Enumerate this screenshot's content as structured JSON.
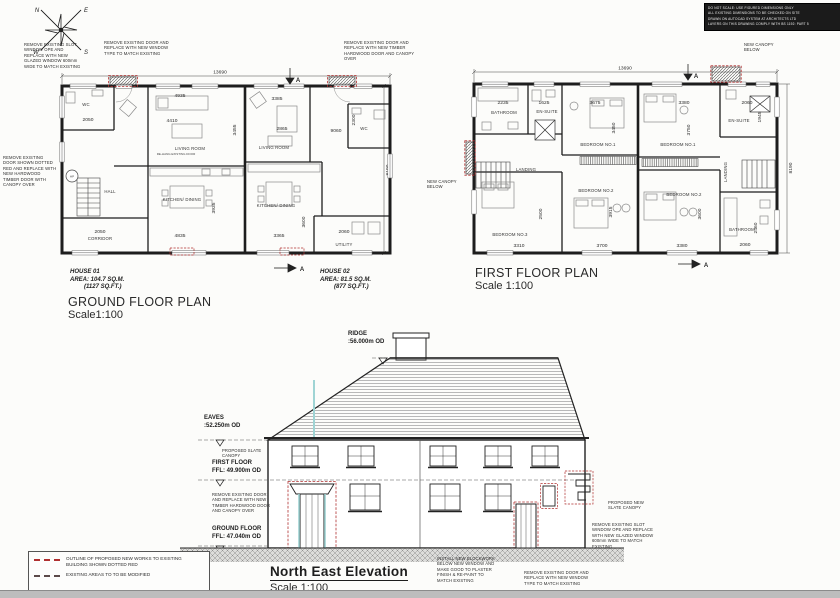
{
  "colors": {
    "ink": "#1d1d1d",
    "proposed_red": "#b03030",
    "teal": "#9fd4d4"
  },
  "compass": {
    "n": "N",
    "e": "E",
    "w": "W",
    "s": "S"
  },
  "notes_block": {
    "l1": "DO NOT SCALE: USE FIGURED DIMENSIONS ONLY",
    "l2": "ALL EXISTING DIMENSIONS TO BE CHECKED ON SITE",
    "l3": "DRAWN ON AUTOCAD SYSTEM AT ARCHITECTS LTD",
    "l4": "LAYERS ON THIS DRAWING COMPLY WITH BS 1192: PART 5"
  },
  "annotations": {
    "slot_window": "REMOVE EXISTING SLOT WINDOW OPE AND REPLACE WITH NEW GLAZED WINDOW 600mm WIDE TO MATCH EXISTING",
    "door_to_window": "REMOVE EXISTING DOOR AND REPLACE WITH NEW WINDOW TYPE TO MATCH EXISTING",
    "door_timber": "REMOVE EXISTING DOOR AND REPLACE WITH NEW TIMBER HARDWOOD DOOR AND CANOPY OVER",
    "door_dotted": "REMOVE EXISTING DOOR SHOWN DOTTED RED AND REPLACE WITH NEW HARDWOOD TIMBER DOOR WITH CANOPY OVER",
    "canopy_below": "NEW CANOPY BELOW",
    "rehang": "RE-HANG EXISTING DOOR",
    "section": "A"
  },
  "ground_floor": {
    "title": "GROUND FLOOR PLAN",
    "scale": "Scale1:100",
    "house01": {
      "name": "HOUSE 01",
      "area_m": "AREA: 104.7 SQ.M.",
      "area_ft": "(1127 SQ.FT.)"
    },
    "house02": {
      "name": "HOUSE 02",
      "area_m": "AREA: 81.5 SQ.M.",
      "area_ft": "(877 SQ.FT.)"
    },
    "rooms": {
      "wc1": "WC",
      "living1": "LIVING ROOM",
      "hall": "HALL",
      "kitchen1": "KITCHEN/ DINING",
      "corridor": "CORRIDOR",
      "living2": "LIVING ROOM",
      "wc2": "WC",
      "kitchen2": "KITCHEN/ DINING",
      "utility": "UTILITY",
      "hp": "HP"
    },
    "dims": {
      "overall": "13690",
      "height": "8190",
      "wc1": "2050",
      "living1_w": "4935",
      "living1_w2": "4410",
      "living1_h": "3455",
      "kitchen1_h": "3935",
      "kitchen1_w": "4835",
      "corridor": "2050",
      "living2_w": "3385",
      "living2_w2": "2865",
      "hall2": "9060",
      "wc2_h": "2300",
      "kitchen2_w": "3365",
      "kitchen2_h": "3600",
      "utility_w": "2060"
    }
  },
  "first_floor": {
    "title": "FIRST FLOOR PLAN",
    "scale": "Scale 1:100",
    "rooms": {
      "bathroom_l": "BATHROOM",
      "ensuite_l": "EN-SUITE",
      "bed1_l": "BEDROOM NO.1",
      "landing_l": "LANDING",
      "bed3": "BEDROOM NO.3",
      "bed2_c": "BEDROOM NO.2",
      "bed1_r": "BEDROOM NO.1",
      "ensuite_r": "EN-SUITE",
      "bed2_r": "BEDROOM NO.2",
      "landing_r": "LANDING",
      "bathroom_r": "BATHROOM"
    },
    "dims": {
      "overall": "13690",
      "height": "8190",
      "bath_l_w": "2235",
      "ensuite_l_w": "1625",
      "bed1_l_w": "3675",
      "bed1_l_h": "3450",
      "bed1_r_w": "3380",
      "bed1_r_h": "3750",
      "ensuite_r_w": "2060",
      "ensuite_r_h": "1945",
      "bed3_w": "3310",
      "bed3_h": "2500",
      "bed2_c_w": "3700",
      "bed2_c_h": "3915",
      "bed2_r_w": "3380",
      "bed2_r_h": "3600",
      "bath_r_w": "2060",
      "bath_r_h": "2460"
    }
  },
  "elevation": {
    "title": "North East Elevation",
    "scale": "Scale 1:100",
    "levels": {
      "ridge": "RIDGE",
      "ridge_v": ":56.000m OD",
      "eaves": "EAVES",
      "eaves_v": ":52.250m OD",
      "ff": "FIRST FLOOR",
      "ff_v": "FFL: 49.900m OD",
      "gf": "GROUND FLOOR",
      "gf_v": "FFL: 47.040m OD"
    },
    "notes": {
      "slate_canopy": "PROPOSED SLATE CANOPY",
      "remove_door_left": "REMOVE EXISTING DOOR AND REPLACE WITH NEW TIMBER HARDWOOD DOOR AND CANOPY OVER",
      "new_slate_canopy": "PROPOSED NEW SLATE CANOPY",
      "remove_slot_window": "REMOVE EXISTING SLOT WINDOW OPE AND REPLACE WITH NEW GLAZED WINDOW 600mm WIDE TO MATCH EXISTING",
      "install_blockwork": "INSTALL NEW BLOCKWORK BELOW NEW WINDOW AND MAKE GOOD TO PLASTER FINISH & RE-PAINT TO MATCH EXISTING",
      "remove_door_right": "REMOVE EXISTING DOOR AND REPLACE WITH NEW WINDOW TYPE TO MATCH EXISTING"
    }
  },
  "legend": {
    "item1": "OUTLINE OF PROPOSED NEW WORKS TO EXISTING BUILDING SHOWN DOTTED RED",
    "item2": "EXISTING AREAS TO TO BE MODIFIED"
  }
}
